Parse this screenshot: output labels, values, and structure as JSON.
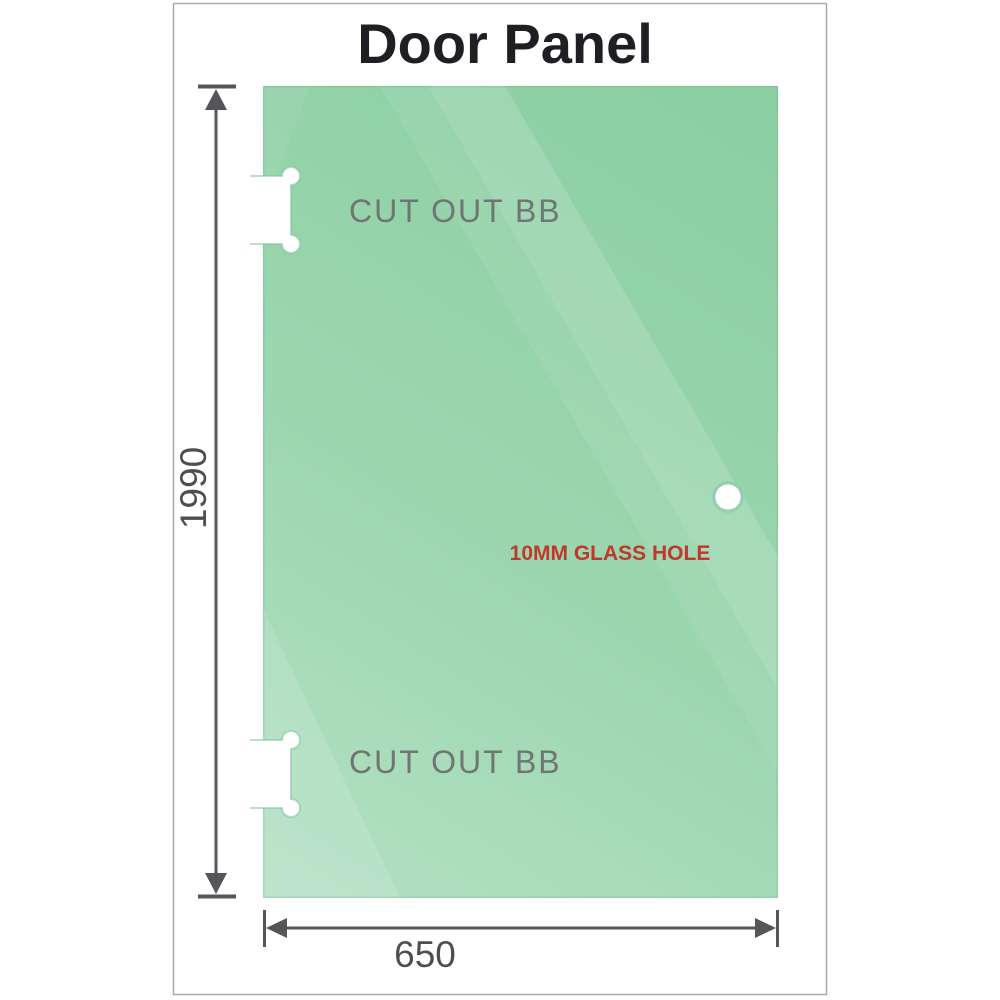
{
  "title": "Door Panel",
  "panel": {
    "top_cutout_label": "CUT OUT BB",
    "bottom_cutout_label": "CUT OUT BB",
    "hole_label": "10MM GLASS HOLE"
  },
  "dimensions": {
    "height_mm": "1990",
    "width_mm": "650"
  },
  "colors": {
    "glass_green_dark": "#8bcea2",
    "glass_green_light": "#b9e4c9",
    "cutout_label_gray": "#6e7573",
    "dimension_text_gray": "#4c4f52",
    "dimension_line_gray": "#55565a",
    "hole_label_red": "#bf382e",
    "frame_border_gray": "#a9abae",
    "title_color": "#1e1f23"
  }
}
